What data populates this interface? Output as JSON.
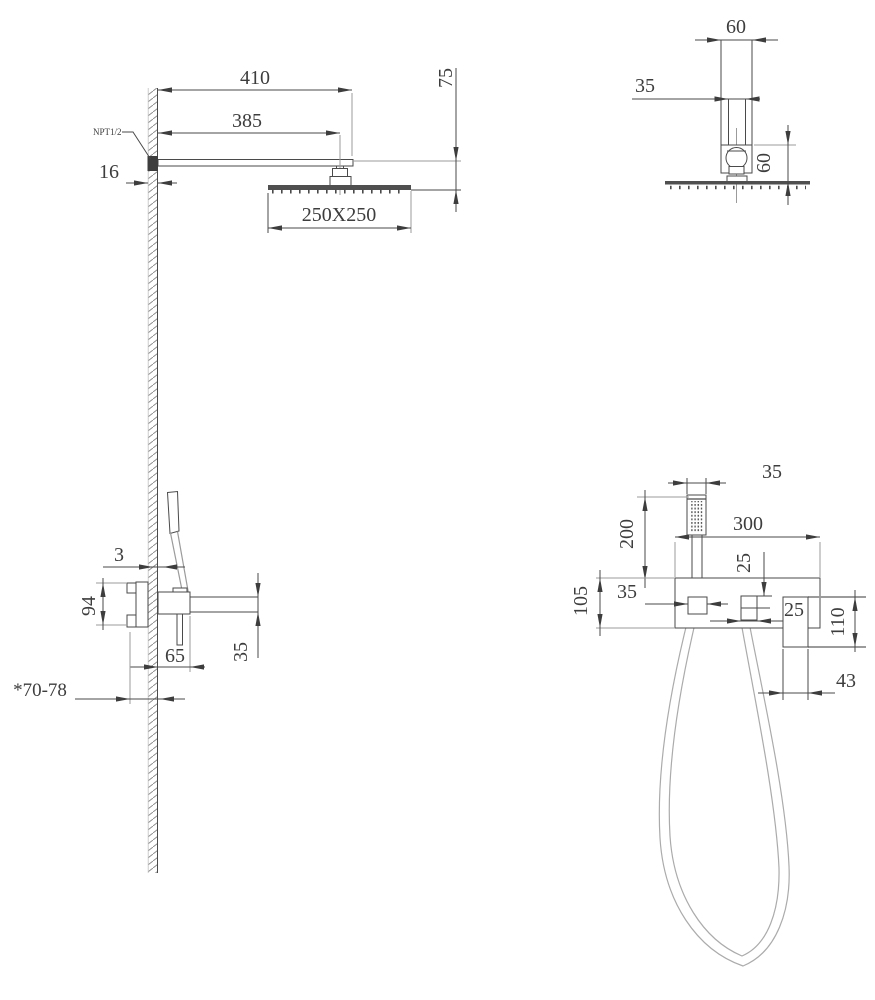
{
  "drawing": {
    "type": "shower-system-installation-dimension-drawing",
    "units_note": "mm",
    "colors": {
      "line": "#4a4a4a",
      "light_line": "#9b9b9b",
      "text": "#3d3d3d",
      "background": "#ffffff"
    }
  },
  "views": {
    "rain_shower_side": {
      "title": "rain shower arm side view",
      "dims": {
        "arm_length": "410",
        "wall_to_head_center": "385",
        "head_drop": "75",
        "wall_thickness": "16",
        "head_size": "250X250",
        "inlet_thread": "NPT1/2"
      }
    },
    "rain_shower_front": {
      "title": "rain shower arm front view",
      "dims": {
        "arm_width": "60",
        "arm_inner_width": "35",
        "connector_height": "60"
      }
    },
    "mixer_side": {
      "title": "mixer valve side view",
      "dims": {
        "handle_wall_gap": "3",
        "valve_body_height": "94",
        "spout_projection": "65",
        "spout_height": "35",
        "rough_in_depth": "*70-78"
      }
    },
    "hand_shower_front": {
      "title": "hand shower and bracket front view",
      "dims": {
        "head_width": "35",
        "hand_shower_length": "200",
        "bracket_width": "300",
        "outlet_top_offset": "25",
        "holder_width": "35",
        "bracket_height": "105",
        "outlet_width": "25",
        "outlet_block_height": "110",
        "outlet_block_width": "43"
      }
    }
  }
}
